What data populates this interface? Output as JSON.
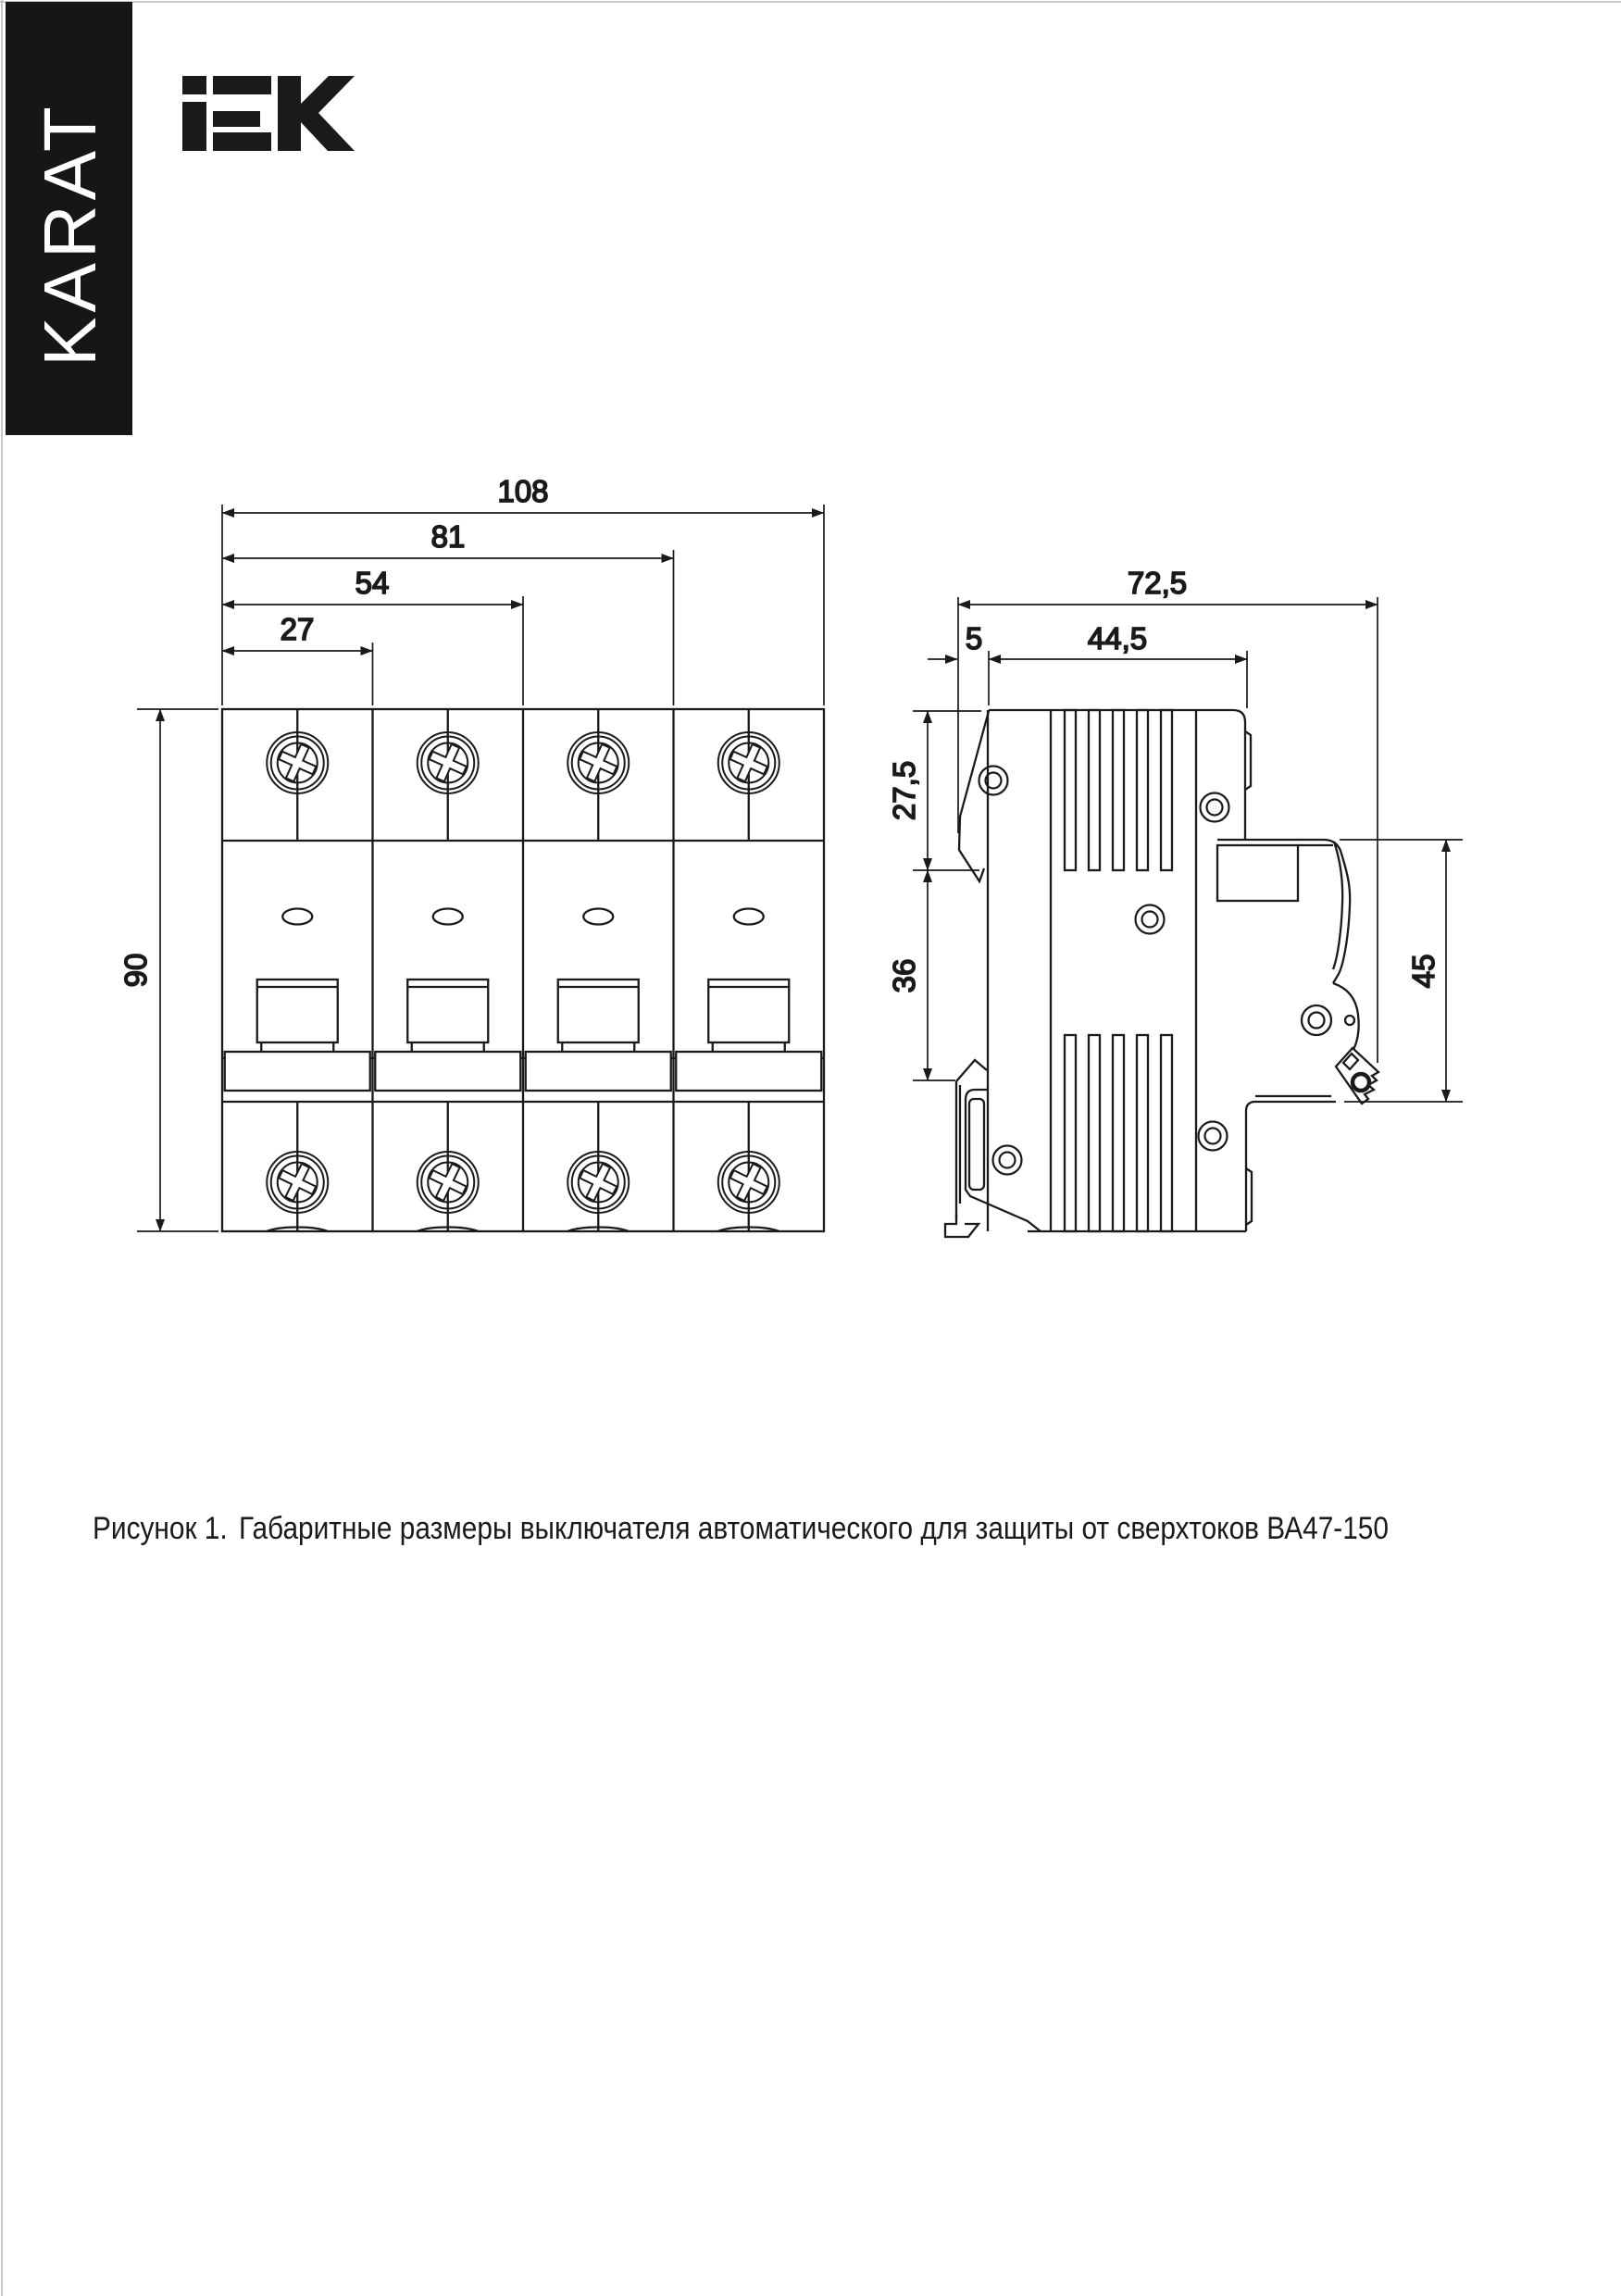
{
  "page": {
    "bg": "#ffffff",
    "ink": "#1a1a1a",
    "border_color": "#aaaaaa"
  },
  "sidebar_banner": {
    "text": "KARAT",
    "bg": "#161616",
    "fg": "#ffffff"
  },
  "brand": {
    "logo": "IEK"
  },
  "dimensions": {
    "front": {
      "overall_width": "108",
      "three_modules": "81",
      "two_modules": "54",
      "one_module": "27",
      "height": "90"
    },
    "side": {
      "overall_depth": "72,5",
      "clip_offset": "5",
      "body_depth": "44,5",
      "upper_height": "27,5",
      "din_rail_span": "36",
      "front_height": "45"
    }
  },
  "caption": {
    "figure": "Рисунок 1.",
    "text": "Габаритные размеры выключателя автоматического для защиты от сверхтоков ВА47-150"
  }
}
